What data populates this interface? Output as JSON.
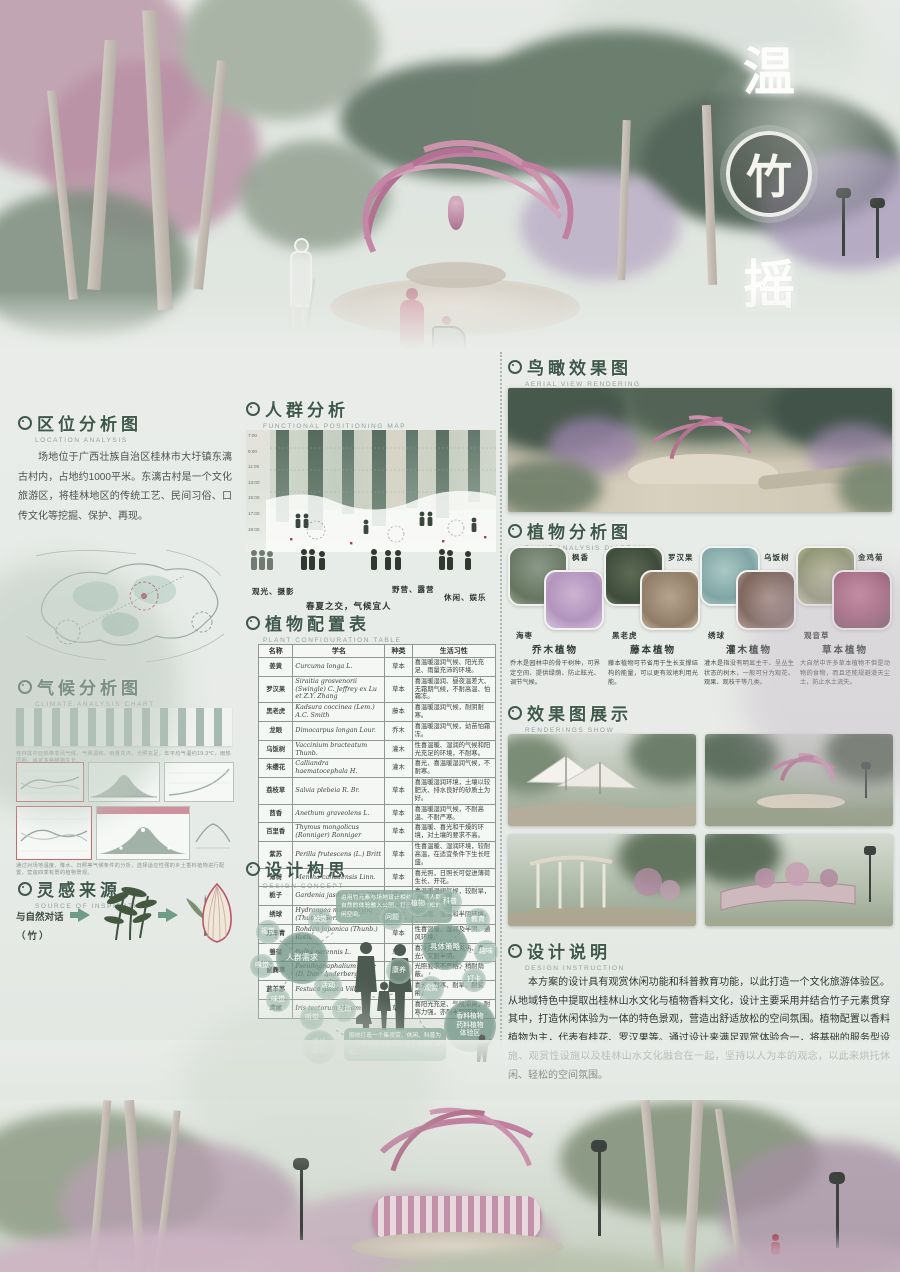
{
  "poster": {
    "title_chars": [
      "温",
      "竹",
      "摇"
    ],
    "accent_pink": "#c07fa0",
    "accent_green": "#3f584c"
  },
  "sections": {
    "location": {
      "heading": "区位分析图",
      "sub": "LOCATION ANALYSIS",
      "paragraph": "场地位于广西壮族自治区桂林市大圩镇东漓古村内，占地约1000平米。东漓古村是一个文化旅游区，将桂林地区的传统工艺、民间习俗、口传文化等挖掘、保护、再现。"
    },
    "climate": {
      "heading": "气候分析图",
      "sub": "CLIMATE ANALYSIS CHART",
      "note1": "桂林属中亚热带季风气候，气候温和，雨量充沛，光照充足，年平均气温约19.3℃，雨热同期，适宜多种植物生长。",
      "note2": "通过对场地温度、降水、日照等气候条件的分析，选择适应性强的乡土香料植物进行配置，营造四季有景的植物景观。"
    },
    "inspiration": {
      "heading": "灵感来源",
      "sub": "SOURCE OF INSPIRATION",
      "line1": "与自然对话",
      "line2": "（竹）"
    },
    "crowd": {
      "heading": "人群分析",
      "sub": "FUNCTIONAL POSITIONING MAP",
      "times": [
        "7:00",
        "9:00",
        "11:00",
        "13:00",
        "15:00",
        "17:00",
        "19:00"
      ],
      "labels": [
        "观光、摄影",
        "春夏之交，气候宜人",
        "野营、露营",
        "休闲、娱乐"
      ]
    },
    "plant_table": {
      "heading": "植物配置表",
      "sub": "PLANT CONFIGURATION TABLE",
      "columns": [
        "名称",
        "学名",
        "种类",
        "生活习性"
      ],
      "rows": [
        {
          "name": "姜黄",
          "sci": "Curcuma longa L.",
          "type": "草本",
          "habit": "喜温暖湿润气候、阳光充足、雨量充沛的环境。"
        },
        {
          "name": "罗汉果",
          "sci": "Siraitia grosvenorii (Swingle) C. Jeffrey ex Lu et Z.Y. Zhang",
          "type": "草本",
          "habit": "喜温暖湿润、昼夜温差大、无霜期气候，不耐高温、怕霜冻。"
        },
        {
          "name": "黑老虎",
          "sci": "Kadsura coccinea (Lem.) A.C. Smith",
          "type": "藤本",
          "habit": "喜温暖湿润气候，耐阴耐寒。"
        },
        {
          "name": "龙眼",
          "sci": "Dimocarpus longan Lour.",
          "type": "乔木",
          "habit": "喜温暖湿润气候，幼苗怕霜冻。"
        },
        {
          "name": "乌饭树",
          "sci": "Vaccinium bracteatum Thunb.",
          "type": "灌木",
          "habit": "性喜温暖、湿润的气候和阳光充足的环境，不耐寒。"
        },
        {
          "name": "朱缨花",
          "sci": "Calliandra haematocephala H.",
          "type": "灌木",
          "habit": "喜光、喜温暖湿润气候，不耐寒。"
        },
        {
          "name": "荔枝草",
          "sci": "Salvia plebeia R. Br.",
          "type": "草本",
          "habit": "喜温暖湿润环境，土壤以较肥沃、排水良好的砂质土为好。"
        },
        {
          "name": "茴香",
          "sci": "Anethum graveolens L.",
          "type": "草本",
          "habit": "喜温暖湿润气候，不耐高温、不耐严寒。"
        },
        {
          "name": "百里香",
          "sci": "Thymus mongolicus (Ronniger) Ronniger",
          "type": "草本",
          "habit": "喜温暖、喜光和干燥的环境，对土壤的要求不高。"
        },
        {
          "name": "紫苏",
          "sci": "Perilla frutescens (L.) Britt",
          "type": "草本",
          "habit": "性喜温暖、湿润环境，较耐高温，在适宜条件下生长旺盛。"
        },
        {
          "name": "薄荷",
          "sci": "Mentha canadensis Linn.",
          "type": "草本",
          "habit": "喜光照，日照长可促进薄荷生长、开花。"
        },
        {
          "name": "栀子",
          "sci": "Gardenia jasminoides Ellis",
          "type": "灌木",
          "habit": "喜温暖湿润气候，较耐旱，适荫。"
        },
        {
          "name": "绣球",
          "sci": "Hydrangea macrophylla (Thunb.) Ser.",
          "type": "灌木",
          "habit": "喜温暖、湿润和半阴环境。"
        },
        {
          "name": "万年青",
          "sci": "Rohdea japonica (Thunb.) Roth.",
          "type": "草本",
          "habit": "性喜温暖、湿润及半阴、通风环境。"
        },
        {
          "name": "雏菊",
          "sci": "Bellis perennis L.",
          "type": "草本",
          "habit": "喜冷凉气候，忌炎热、喜光，又耐半阴。"
        },
        {
          "name": "鼠麴草",
          "sci": "Pseudognaphalium affine (D. Don) Anderberg",
          "type": "草本",
          "habit": "光照要求不严格，稍耐荫蔽。"
        },
        {
          "name": "蓝羊茅",
          "sci": "Festuca glauca Vill.",
          "type": "草本",
          "habit": "喜光、耐寒、耐旱、耐贫瘠。"
        },
        {
          "name": "鸢尾",
          "sci": "Iris tectorum Maxim.",
          "type": "草本",
          "habit": "喜阳光充足、气候凉爽，耐寒力强，亦耐半阴环境。"
        }
      ]
    },
    "concept": {
      "heading": "设计构思",
      "sub": "DESIGN CONCEPT",
      "speech1": "运用竹元素与场地设计相结合，将人群与自然的体验融入公园，打造舒适放松的休闲空间。",
      "speech2": "围绕打造一个集观赏、休闲、科普为一体的特色体验园区展开设计、定位。",
      "left_center": "人群需求",
      "left_sub": "活动",
      "senses": [
        "视觉",
        "嗅觉",
        "味觉",
        "触觉",
        "听觉",
        "互动"
      ],
      "mid_center": "植物感知",
      "mid_sub": "感官",
      "right_center": "具体策略",
      "strategies": [
        "问题",
        "植物",
        "科普",
        "教育",
        "趣味",
        "打卡",
        "观赏",
        "康养"
      ],
      "design1": "设计",
      "design2": "定位",
      "final": [
        "香料植物",
        "药料植物",
        "体验区"
      ]
    },
    "aerial": {
      "heading": "鸟瞰效果图",
      "sub": "AERIAL VIEW RENDERING"
    },
    "plant_analysis": {
      "heading": "植物分析图",
      "sub": "PLANT ANALYSIS DIAGRAM",
      "plants": [
        "枫香",
        "海枣",
        "罗汉果",
        "黑老虎",
        "乌饭树",
        "绣球",
        "金鸡菊",
        "观音草"
      ],
      "categories": [
        {
          "name": "乔木植物",
          "desc": "乔木是园林中的骨干树种，可界定空间、提供绿荫、防止眩光、调节气候。"
        },
        {
          "name": "藤本植物",
          "desc": "藤本植物可节省用于生长支撑结构的能量，可以更有效地利用光能。"
        },
        {
          "name": "灌木植物",
          "desc": "灌木是指没有明显主干、呈丛生状态的树木，一般可分为观花、观果、观枝干等几类。"
        },
        {
          "name": "草本植物",
          "desc": "大自然中许多草本植物不但是动物的食物，而且还能规避漫天尘土，防止水土流失。"
        }
      ]
    },
    "renderings": {
      "heading": "效果图展示",
      "sub": "RENDERINGS SHOW"
    },
    "description": {
      "heading": "设计说明",
      "sub": "DESIGN INSTRUCTION",
      "paragraph": "本方案的设计具有观赏休闲功能和科普教育功能，以此打造一个文化旅游体验区。从地域特色中提取出桂林山水文化与植物香料文化，设计主要采用并结合竹子元素贯穿其中，打造休闲体验为一体的特色景观，营造出舒适放松的空间氛围。植物配置以香料植物为主，代表有桂花、罗汉果等。通过设计来满足观赏体验合一，将基础的服务型设施、观赏性设施以及桂林山水文化融合在一起，坚持以人为本的观念，以此来烘托休闲、轻松的空间氛围。"
    }
  }
}
